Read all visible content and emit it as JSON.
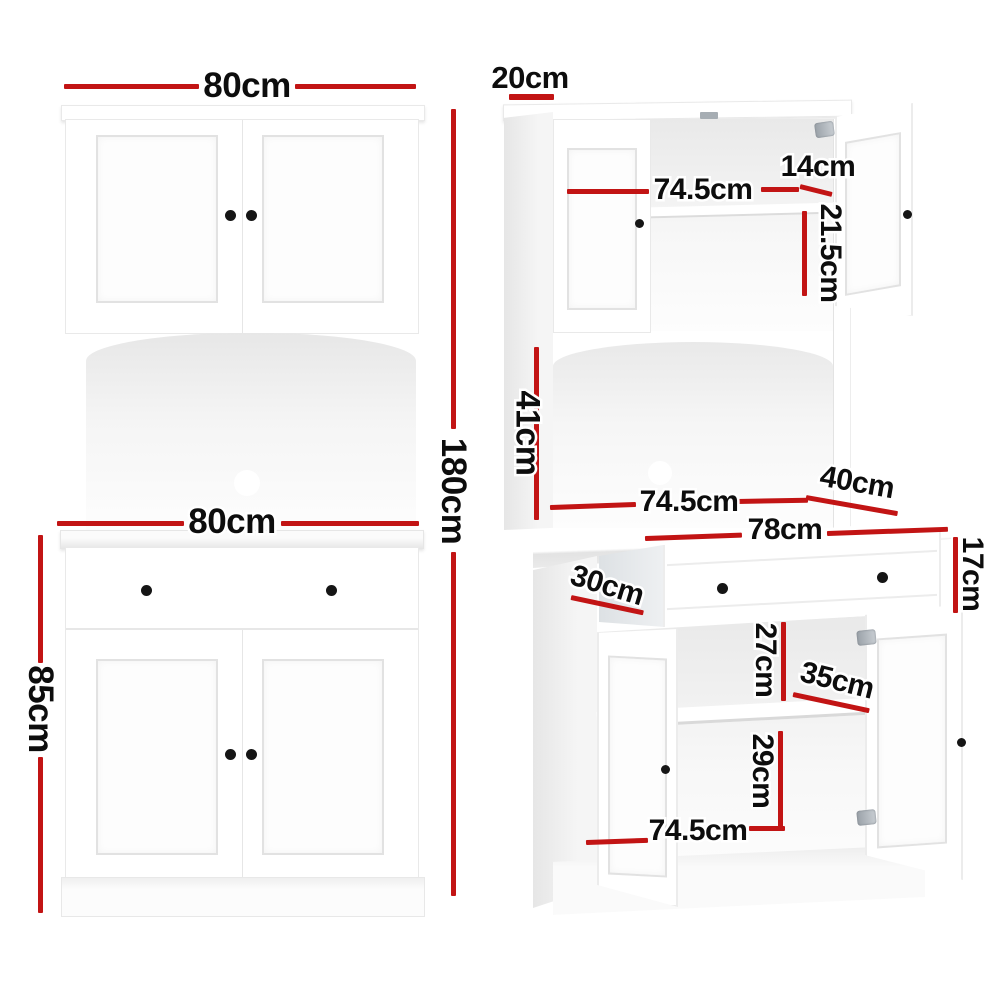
{
  "front": {
    "top_width": "80cm",
    "total_height": "180cm",
    "bench_width": "80cm",
    "base_height": "85cm"
  },
  "persp": {
    "top_depth": "20cm",
    "hutch_inner_width": "74.5cm",
    "hutch_door_width": "14cm",
    "hutch_inner_height": "21.5cm",
    "alcove_height": "41cm",
    "alcove_width": "74.5cm",
    "bench_depth": "40cm",
    "drawer_width": "78cm",
    "drawer_height": "17cm",
    "drawer_depth": "30cm",
    "upper_compartment_height": "27cm",
    "shelf_depth": "35cm",
    "lower_compartment_height": "29cm",
    "base_inner_width": "74.5cm"
  },
  "colors": {
    "dimension_line": "#c21414",
    "label_text": "#0d0d0d",
    "cabinet": "#ffffff"
  }
}
